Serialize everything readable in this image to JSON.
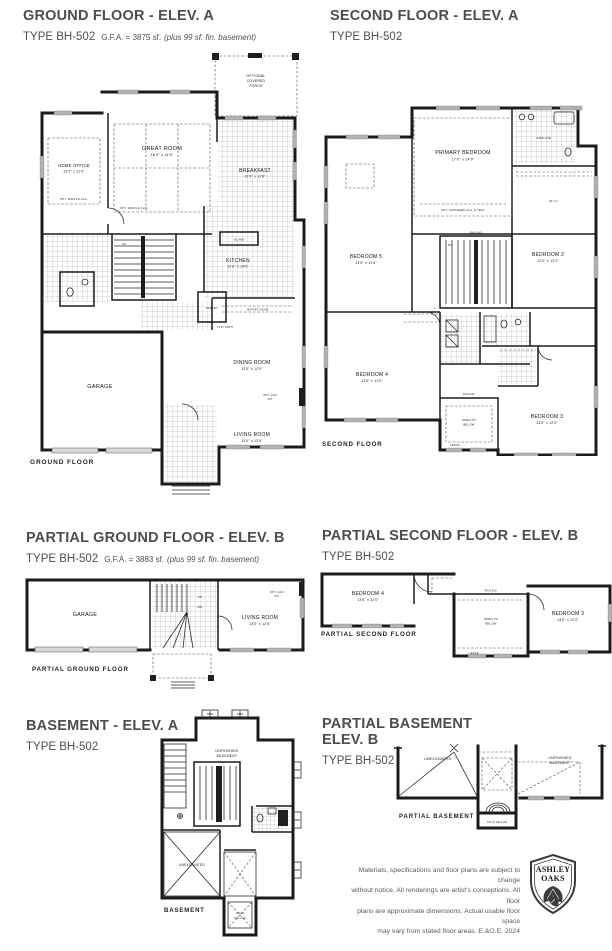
{
  "page": {
    "bg": "#ffffff",
    "ink": "#1b1b1b",
    "title_color": "#4d4d4d"
  },
  "panels": {
    "ground_floor": {
      "title": "GROUND FLOOR - ELEV. A",
      "type_label": "TYPE BH-502",
      "gfa": "G.F.A. = 3875 sf.",
      "gfa_note": "(plus 99 sf. fin. basement)",
      "caption": "GROUND FLOOR",
      "rooms": {
        "home_office": {
          "label": "HOME OFFICE",
          "dims": "12'0\" x 11'0\""
        },
        "great_room": {
          "label": "GREAT ROOM",
          "dims": "18'0\" x 14'0\""
        },
        "breakfast": {
          "label": "BREAKFAST",
          "dims": "12'0\" x 11'0\""
        },
        "kitchen": {
          "label": "KITCHEN",
          "dims": "12'0\" x 14'6\""
        },
        "pantry": {
          "label": "PANTRY"
        },
        "island": {
          "label": "ISLAND"
        },
        "dining_room": {
          "label": "DINING ROOM",
          "dims": "13'0\" x 12'0\""
        },
        "living_room": {
          "label": "LIVING ROOM",
          "dims": "13'0\" x 12'6\""
        },
        "garage": {
          "label": "GARAGE"
        },
        "porch": {
          "l1": "OPTIONAL",
          "l2": "COVERED",
          "l3": "PORCH"
        }
      },
      "notes": {
        "waffle": "OPT. WAFFLE CLG.",
        "buffet": "BUFFET NICHE",
        "flat_arch": "FLAT ARCH",
        "gas_fp1": "OPT. GAS",
        "gas_fp2": "F/P",
        "up": "UP"
      }
    },
    "second_floor": {
      "title": "SECOND FLOOR - ELEV. A",
      "type_label": "TYPE BH-502",
      "caption": "SECOND FLOOR",
      "rooms": {
        "primary": {
          "label": "PRIMARY BEDROOM",
          "dims": "17'0\" x 14'0\""
        },
        "bedroom5": {
          "label": "BEDROOM 5",
          "dims": "13'0\" x 11'6\""
        },
        "bedroom2": {
          "label": "BEDROOM 2",
          "dims": "12'0\" x 12'0\""
        },
        "bedroom4": {
          "label": "BEDROOM 4",
          "dims": "13'6\" x 11'0\""
        },
        "bedroom3": {
          "label": "BEDROOM 3",
          "dims": "13'0\" x 12'0\""
        },
        "ensuite": {
          "label": "ENSUITE"
        },
        "wic": {
          "label": "W.I.C."
        }
      },
      "notes": {
        "coffered": "OPT. COFFERED CLG. & TRAY",
        "railing": "RAILING",
        "open1": "OPEN TO",
        "open2": "BELOW",
        "ledge": "LEDGE",
        "dn": "DN",
        "linen": "L"
      }
    },
    "partial_ground": {
      "title": "PARTIAL GROUND FLOOR - ELEV. B",
      "type_label": "TYPE BH-502",
      "gfa": "G.F.A. = 3883 sf.",
      "gfa_note": "(plus 99 sf. fin. basement)",
      "caption": "PARTIAL GROUND FLOOR",
      "rooms": {
        "garage": {
          "label": "GARAGE"
        },
        "living_room": {
          "label": "LIVING ROOM",
          "dims": "13'0\" x 12'6\""
        }
      },
      "notes": {
        "up": "UP",
        "dn": "DN",
        "gas_fp1": "OPT. GAS",
        "gas_fp2": "F/P"
      }
    },
    "partial_second": {
      "title": "PARTIAL SECOND FLOOR - ELEV. B",
      "type_label": "TYPE BH-502",
      "caption": "PARTIAL SECOND FLOOR",
      "rooms": {
        "bedroom4": {
          "label": "BEDROOM 4",
          "dims": "13'6\" x 11'0\""
        },
        "bedroom3": {
          "label": "BEDROOM 3",
          "dims": "13'0\" x 12'0\""
        }
      },
      "notes": {
        "railing": "RAILING",
        "open1": "OPEN TO",
        "open2": "BELOW",
        "ledge": "LEDGE"
      }
    },
    "basement": {
      "title": "BASEMENT - ELEV. A",
      "type_label": "TYPE BH-502",
      "caption": "BASEMENT",
      "labels": {
        "unfinished1": "UNFINISHED",
        "unfinished2": "BASEMENT",
        "unexcavated": "UNEXCAVATED",
        "cold1": "COLD",
        "cold2": "CELLAR"
      }
    },
    "partial_basement": {
      "title1": "PARTIAL BASEMENT",
      "title2": "ELEV. B",
      "type_label": "TYPE BH-502",
      "caption": "PARTIAL BASEMENT",
      "labels": {
        "unexcavated": "UNEXCAVATED",
        "unfinished1": "UNFINISHED",
        "unfinished2": "BASEMENT",
        "cold": "COLD CELLAR"
      }
    }
  },
  "footer": {
    "disclaimer": {
      "l1": "Materials, specifications and floor plans are subject to change",
      "l2": "without notice.  All renderings are artist's conceptions. All floor",
      "l3": "plans are approximate dimensions.  Actual usable floor space",
      "l4": "may vary from stated floor areas. E.&O.E. 2024"
    },
    "logo": {
      "line1": "ASHLEY",
      "line2": "OAKS"
    }
  }
}
